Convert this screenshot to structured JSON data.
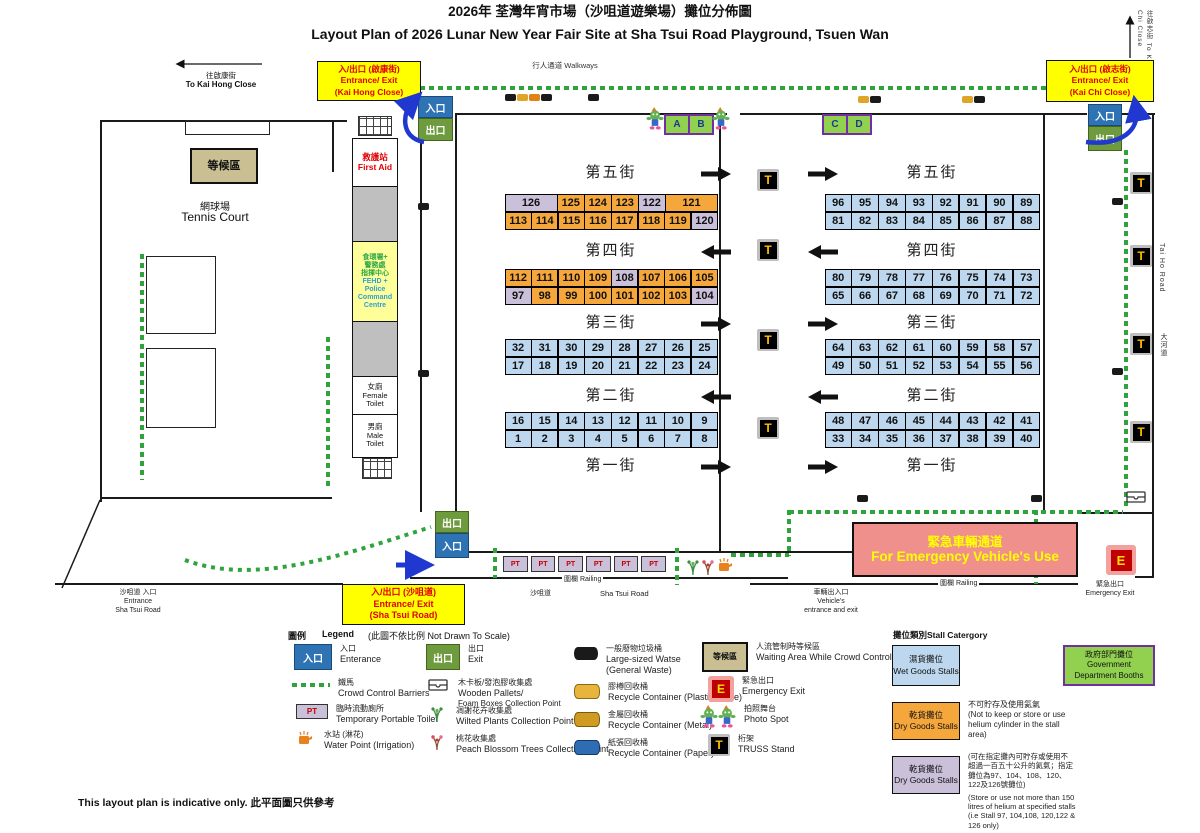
{
  "title": {
    "zh": "2026年 荃灣年宵市場（沙咀道遊樂場）攤位分佈圖",
    "en": "Layout Plan of 2026 Lunar New Year Fair Site at Sha Tsui Road Playground, Tsuen Wan"
  },
  "labels": {
    "walkways": "行人通道 Walkways",
    "entrance": "入口",
    "exit": "出口",
    "to_kai_hong_zh": "往啟康街",
    "to_kai_hong_en": "To Kai Hong Close",
    "to_kai_chi": "往啟志街 To Kai Chi Close",
    "tai_ho_en": "Tai Ho Road",
    "tai_ho_zh": "大河道",
    "sha_tsui_zh": "沙咀道",
    "sha_tsui_en": "Sha Tsui Road",
    "railing": "圍欄  Railing",
    "waiting_area": "等候區",
    "tennis_zh": "網球場",
    "tennis_en": "Tennis Court",
    "entrance_sha_tsui": [
      "沙咀道 入口",
      "Entrance",
      "Sha Tsui Road"
    ],
    "vehicle": [
      "車輛出入口",
      "Vehicle's",
      "entrance and exit"
    ],
    "emergency_exit_zh": "緊急出口",
    "emergency_exit_en": "Emergency Exit",
    "footer": "This layout plan is indicative only. 此平面圖只供參考"
  },
  "entrances": {
    "kai_hong": [
      "入/出口 (啟康街)",
      "Entrance/ Exit",
      "(Kai Hong Close)"
    ],
    "kai_chi": [
      "入/出口 (啟志街)",
      "Entrance/ Exit",
      "(Kai Chi Close)"
    ],
    "sha_tsui": [
      "入/出口 (沙咀道)",
      "Entrance/ Exit",
      "(Sha Tsui Road)"
    ]
  },
  "facilities": {
    "first_aid": [
      "救護站",
      "First Aid"
    ],
    "fehd_zh": [
      "食環署+",
      "警務處",
      "指揮中心"
    ],
    "fehd_en": [
      "FEHD +",
      "Police",
      "Command",
      "Centre"
    ],
    "female_toilet": [
      "女廁",
      "Female",
      "Toilet"
    ],
    "male_toilet": [
      "男廁",
      "Male",
      "Toilet"
    ]
  },
  "corridor": [
    "緊急車輛通道",
    "For Emergency Vehicle's Use"
  ],
  "booths": [
    "A",
    "B",
    "C",
    "D"
  ],
  "truss_label": "T",
  "pt_label": "PT",
  "e_label": "E",
  "colors": {
    "o": "#F6A73C",
    "p": "#CBC0DA",
    "b": "#BDD7EE"
  },
  "streets": {
    "left": [
      {
        "name": "第五街",
        "dir": "right",
        "rows": [
          [
            {
              "n": "126",
              "c": "p",
              "w": 2
            },
            {
              "n": "125",
              "c": "o"
            },
            {
              "n": "124",
              "c": "o"
            },
            {
              "n": "123",
              "c": "o"
            },
            {
              "n": "122",
              "c": "p"
            },
            {
              "n": "121",
              "c": "o",
              "w": 2
            }
          ],
          [
            {
              "n": "113",
              "c": "o"
            },
            {
              "n": "114",
              "c": "o"
            },
            {
              "n": "115",
              "c": "o"
            },
            {
              "n": "116",
              "c": "o"
            },
            {
              "n": "117",
              "c": "o"
            },
            {
              "n": "118",
              "c": "o"
            },
            {
              "n": "119",
              "c": "o"
            },
            {
              "n": "120",
              "c": "p"
            }
          ]
        ]
      },
      {
        "name": "第四街",
        "dir": "left",
        "rows": [
          [
            {
              "n": "112",
              "c": "o"
            },
            {
              "n": "111",
              "c": "o"
            },
            {
              "n": "110",
              "c": "o"
            },
            {
              "n": "109",
              "c": "o"
            },
            {
              "n": "108",
              "c": "p"
            },
            {
              "n": "107",
              "c": "o"
            },
            {
              "n": "106",
              "c": "o"
            },
            {
              "n": "105",
              "c": "o"
            }
          ],
          [
            {
              "n": "97",
              "c": "p"
            },
            {
              "n": "98",
              "c": "o"
            },
            {
              "n": "99",
              "c": "o"
            },
            {
              "n": "100",
              "c": "o"
            },
            {
              "n": "101",
              "c": "o"
            },
            {
              "n": "102",
              "c": "o"
            },
            {
              "n": "103",
              "c": "o"
            },
            {
              "n": "104",
              "c": "p"
            }
          ]
        ]
      },
      {
        "name": "第三街",
        "dir": "right",
        "rows": [
          [
            {
              "n": "32",
              "c": "b"
            },
            {
              "n": "31",
              "c": "b"
            },
            {
              "n": "30",
              "c": "b"
            },
            {
              "n": "29",
              "c": "b"
            },
            {
              "n": "28",
              "c": "b"
            },
            {
              "n": "27",
              "c": "b"
            },
            {
              "n": "26",
              "c": "b"
            },
            {
              "n": "25",
              "c": "b"
            }
          ],
          [
            {
              "n": "17",
              "c": "b"
            },
            {
              "n": "18",
              "c": "b"
            },
            {
              "n": "19",
              "c": "b"
            },
            {
              "n": "20",
              "c": "b"
            },
            {
              "n": "21",
              "c": "b"
            },
            {
              "n": "22",
              "c": "b"
            },
            {
              "n": "23",
              "c": "b"
            },
            {
              "n": "24",
              "c": "b"
            }
          ]
        ]
      },
      {
        "name": "第二街",
        "dir": "left",
        "rows": [
          [
            {
              "n": "16",
              "c": "b"
            },
            {
              "n": "15",
              "c": "b"
            },
            {
              "n": "14",
              "c": "b"
            },
            {
              "n": "13",
              "c": "b"
            },
            {
              "n": "12",
              "c": "b"
            },
            {
              "n": "11",
              "c": "b"
            },
            {
              "n": "10",
              "c": "b"
            },
            {
              "n": "9",
              "c": "b"
            }
          ],
          [
            {
              "n": "1",
              "c": "b"
            },
            {
              "n": "2",
              "c": "b"
            },
            {
              "n": "3",
              "c": "b"
            },
            {
              "n": "4",
              "c": "b"
            },
            {
              "n": "5",
              "c": "b"
            },
            {
              "n": "6",
              "c": "b"
            },
            {
              "n": "7",
              "c": "b"
            },
            {
              "n": "8",
              "c": "b"
            }
          ]
        ]
      },
      {
        "name": "第一街",
        "dir": "right",
        "rows": []
      }
    ],
    "right": [
      {
        "name": "第五街",
        "dir": "right",
        "rows": [
          [
            {
              "n": "96",
              "c": "b"
            },
            {
              "n": "95",
              "c": "b"
            },
            {
              "n": "94",
              "c": "b"
            },
            {
              "n": "93",
              "c": "b"
            },
            {
              "n": "92",
              "c": "b"
            },
            {
              "n": "91",
              "c": "b"
            },
            {
              "n": "90",
              "c": "b"
            },
            {
              "n": "89",
              "c": "b"
            }
          ],
          [
            {
              "n": "81",
              "c": "b"
            },
            {
              "n": "82",
              "c": "b"
            },
            {
              "n": "83",
              "c": "b"
            },
            {
              "n": "84",
              "c": "b"
            },
            {
              "n": "85",
              "c": "b"
            },
            {
              "n": "86",
              "c": "b"
            },
            {
              "n": "87",
              "c": "b"
            },
            {
              "n": "88",
              "c": "b"
            }
          ]
        ]
      },
      {
        "name": "第四街",
        "dir": "left",
        "rows": [
          [
            {
              "n": "80",
              "c": "b"
            },
            {
              "n": "79",
              "c": "b"
            },
            {
              "n": "78",
              "c": "b"
            },
            {
              "n": "77",
              "c": "b"
            },
            {
              "n": "76",
              "c": "b"
            },
            {
              "n": "75",
              "c": "b"
            },
            {
              "n": "74",
              "c": "b"
            },
            {
              "n": "73",
              "c": "b"
            }
          ],
          [
            {
              "n": "65",
              "c": "b"
            },
            {
              "n": "66",
              "c": "b"
            },
            {
              "n": "67",
              "c": "b"
            },
            {
              "n": "68",
              "c": "b"
            },
            {
              "n": "69",
              "c": "b"
            },
            {
              "n": "70",
              "c": "b"
            },
            {
              "n": "71",
              "c": "b"
            },
            {
              "n": "72",
              "c": "b"
            }
          ]
        ]
      },
      {
        "name": "第三街",
        "dir": "right",
        "rows": [
          [
            {
              "n": "64",
              "c": "b"
            },
            {
              "n": "63",
              "c": "b"
            },
            {
              "n": "62",
              "c": "b"
            },
            {
              "n": "61",
              "c": "b"
            },
            {
              "n": "60",
              "c": "b"
            },
            {
              "n": "59",
              "c": "b"
            },
            {
              "n": "58",
              "c": "b"
            },
            {
              "n": "57",
              "c": "b"
            }
          ],
          [
            {
              "n": "49",
              "c": "b"
            },
            {
              "n": "50",
              "c": "b"
            },
            {
              "n": "51",
              "c": "b"
            },
            {
              "n": "52",
              "c": "b"
            },
            {
              "n": "53",
              "c": "b"
            },
            {
              "n": "54",
              "c": "b"
            },
            {
              "n": "55",
              "c": "b"
            },
            {
              "n": "56",
              "c": "b"
            }
          ]
        ]
      },
      {
        "name": "第二街",
        "dir": "left",
        "rows": [
          [
            {
              "n": "48",
              "c": "b"
            },
            {
              "n": "47",
              "c": "b"
            },
            {
              "n": "46",
              "c": "b"
            },
            {
              "n": "45",
              "c": "b"
            },
            {
              "n": "44",
              "c": "b"
            },
            {
              "n": "43",
              "c": "b"
            },
            {
              "n": "42",
              "c": "b"
            },
            {
              "n": "41",
              "c": "b"
            }
          ],
          [
            {
              "n": "33",
              "c": "b"
            },
            {
              "n": "34",
              "c": "b"
            },
            {
              "n": "35",
              "c": "b"
            },
            {
              "n": "36",
              "c": "b"
            },
            {
              "n": "37",
              "c": "b"
            },
            {
              "n": "38",
              "c": "b"
            },
            {
              "n": "39",
              "c": "b"
            },
            {
              "n": "40",
              "c": "b"
            }
          ]
        ]
      },
      {
        "name": "第一街",
        "dir": "right",
        "rows": []
      }
    ]
  },
  "legend": {
    "title_zh": "圖例",
    "title_en": "Legend",
    "scale_note": "(此圖不依比例  Not Drawn To Scale)",
    "entrance": [
      "入口",
      "Enterance"
    ],
    "exit": [
      "出口",
      "Exit"
    ],
    "barriers": [
      "鐵馬",
      "Crowd Control Barriers"
    ],
    "pallets": [
      "木卡板/發泡膠收集處",
      "Wooden Pallets/",
      "Foam Boxes Collection Point"
    ],
    "pt": [
      "臨時流動廁所",
      "Temporary Portable Toilet"
    ],
    "wilted": [
      "凋謝花卉收集處",
      "Wilted Plants Collection Point"
    ],
    "water": [
      "水站 (淋花)",
      "Water Point (Irrigation)"
    ],
    "peach": [
      "桃花收集處",
      "Peach Blossom Trees Collection Point"
    ],
    "waste": [
      "一般廢物垃圾桶",
      "Large-sized Watse",
      "(General Waste)"
    ],
    "plastic": [
      "膠樽回收桶",
      "Recycle Container (Plastic Bottle)"
    ],
    "metal": [
      "金屬回收桶",
      "Recycle Container (Metal)"
    ],
    "paper": [
      "紙張回收桶",
      "Recycle Container (Paper)"
    ],
    "waiting": [
      "人流管制時等候區",
      "Waiting Area While Crowd Control"
    ],
    "emergency": [
      "緊急出口",
      "Emergency Exit"
    ],
    "photo": [
      "拍照舞台",
      "Photo Spot"
    ],
    "truss": [
      "桁架",
      "TRUSS Stand"
    ]
  },
  "stall_category": {
    "title": "攤位類別Stall Catergory",
    "wet": [
      "濕貨攤位",
      "Wet Goods Stalls"
    ],
    "dry1": [
      "乾貨攤位",
      "Dry Goods Stalls"
    ],
    "dry1_note": [
      "不可貯存及使用氦氣",
      "(Not to keep or store or use",
      "helium cylinder in the stall",
      "area)"
    ],
    "dry2": [
      "乾貨攤位",
      "Dry Goods Stalls"
    ],
    "dry2_note_zh": [
      "(可在指定攤內可貯存或使用不",
      "超過一百五十公升的氦氣；指定",
      "攤位為97、104、108、120、",
      "122及126號攤位)"
    ],
    "dry2_note_en": [
      "(Store or use not more than 150",
      "litres of helium at specified stalls",
      "(i.e Stall 97, 104,108, 120,122 &",
      "126 only)"
    ],
    "gov": [
      "政府部門攤位",
      "Government",
      "Department Booths"
    ]
  }
}
